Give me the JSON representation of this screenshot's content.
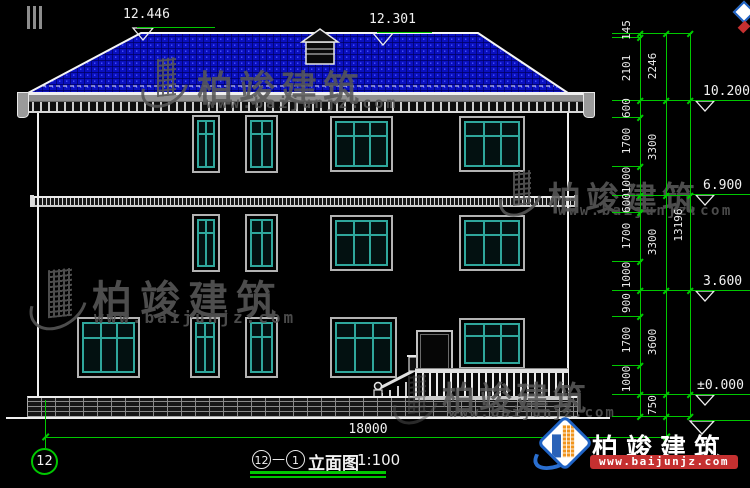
{
  "drawing": {
    "top_elevation_markers": [
      {
        "value": "12.446"
      },
      {
        "value": "12.301"
      }
    ],
    "right_elevation_markers": [
      {
        "value": "10.200"
      },
      {
        "value": "6.900"
      },
      {
        "value": "3.600"
      },
      {
        "value": "±0.000"
      }
    ],
    "dimensions": {
      "col1": [
        "145",
        "2101",
        "600",
        "1700",
        "1000",
        "600",
        "1700",
        "1000",
        "900",
        "1700",
        "1000"
      ],
      "col2": [
        "2246",
        "3300",
        "3300",
        "3600",
        "750"
      ],
      "col3": [
        "13196"
      ],
      "bottom_width": "18000"
    },
    "axis_bubble": "12",
    "title": {
      "axis_start": "12",
      "separator": "—",
      "axis_end": "1",
      "name": "立面图",
      "scale": "1:100"
    }
  },
  "watermark": {
    "brand": "柏竣建筑",
    "website": "www.baijunjz.com"
  },
  "logo": {
    "brand": "柏竣建筑",
    "website": "www.baijunjz.com"
  },
  "colors": {
    "background": "#000000",
    "dimension_green": "#00c800",
    "line_white": "#f0f0f0",
    "roof_blue": "#0a10c0",
    "window_teal": "#2fa79c",
    "watermark_gray": "#5a5a5a",
    "logo_blue": "#1e62c4",
    "logo_orange": "#f0941d",
    "logo_red": "#c53030"
  }
}
